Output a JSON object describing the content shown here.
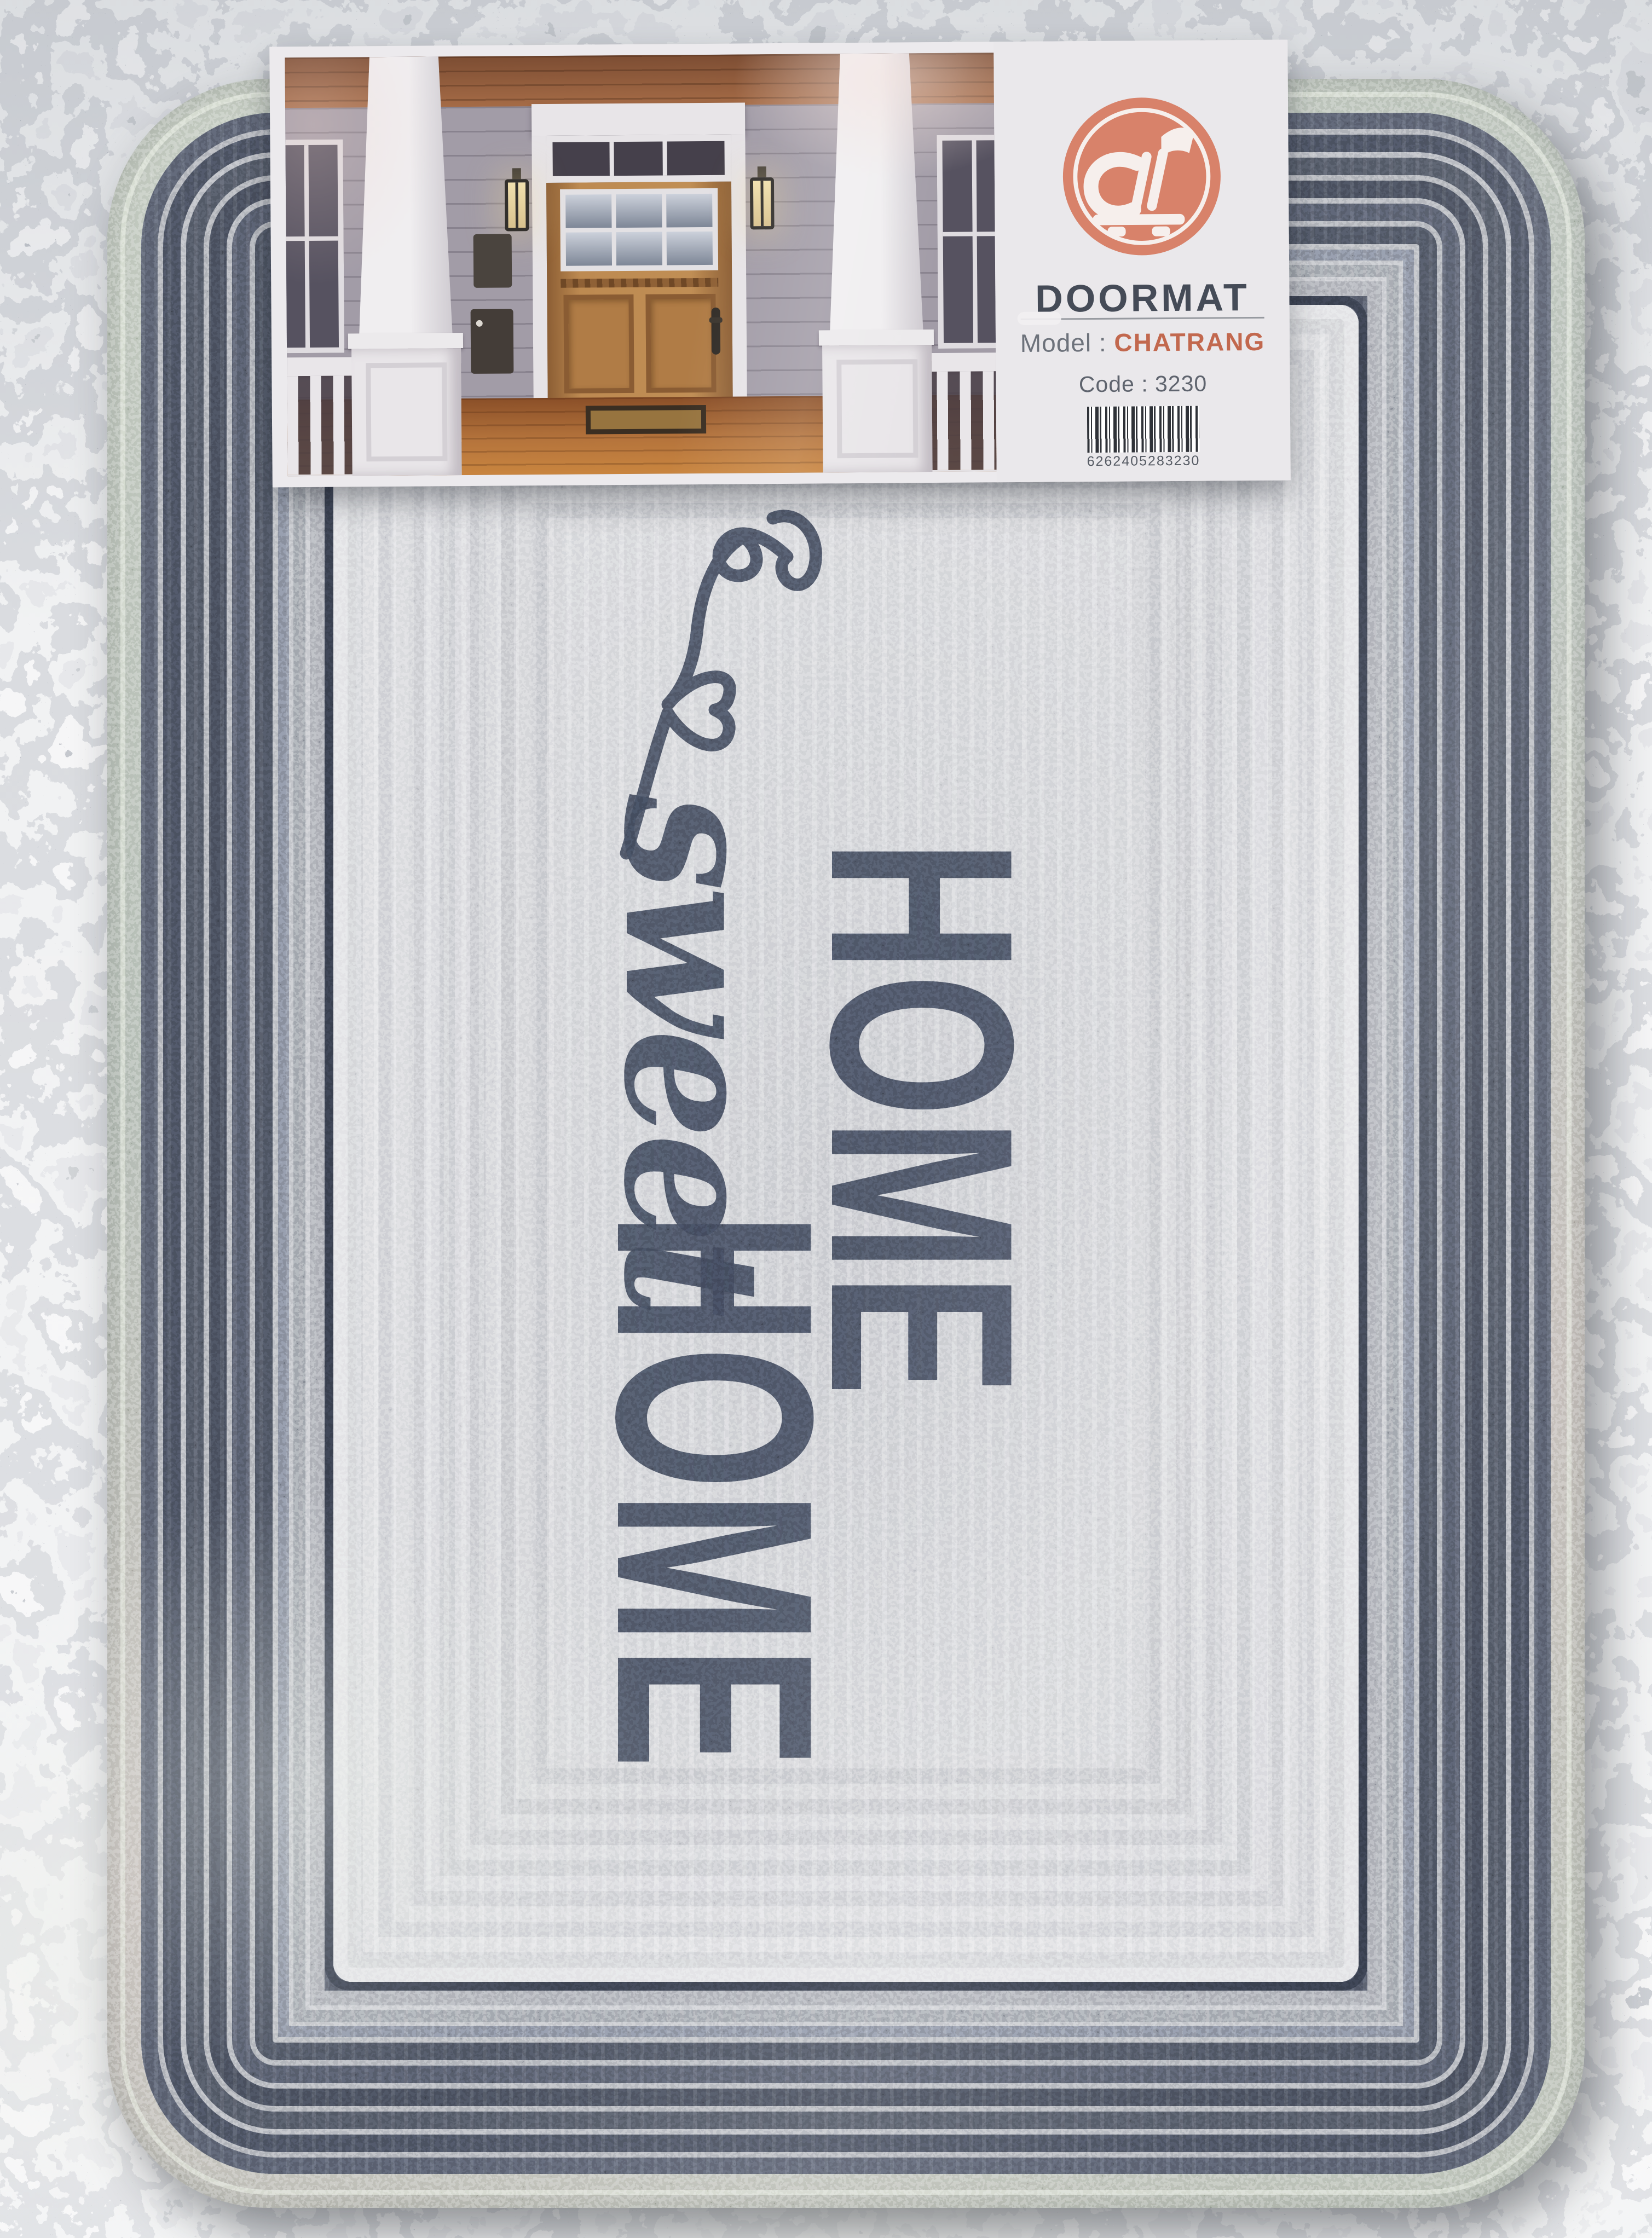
{
  "label_card": {
    "logo_icon": "shopping-cart-brand-logo",
    "logo_color": "#d8826a",
    "title": "DOORMAT",
    "model_label": "Model :",
    "model_value": "CHATRANG",
    "code_text": "Code : 3230",
    "barcode_digits": "6262405283230"
  },
  "doormat": {
    "word_line1": "HOME",
    "word_script": "sweet",
    "word_line2": "HOME",
    "decoration_icon": "heart-swirl-flourish",
    "text_color": "#343a48",
    "border_braid_color": "#3e434f",
    "panel_color": "#cbccd1",
    "binding_color": "#a3ae9f"
  },
  "colors": {
    "granite_base": "#c6c8ca",
    "granite_dark_fleck": "#474d57",
    "label_title_color": "#454b57",
    "label_gray_text": "#6d727b",
    "model_value_color": "#c2684e",
    "frame_line_color": "#2c313d"
  }
}
